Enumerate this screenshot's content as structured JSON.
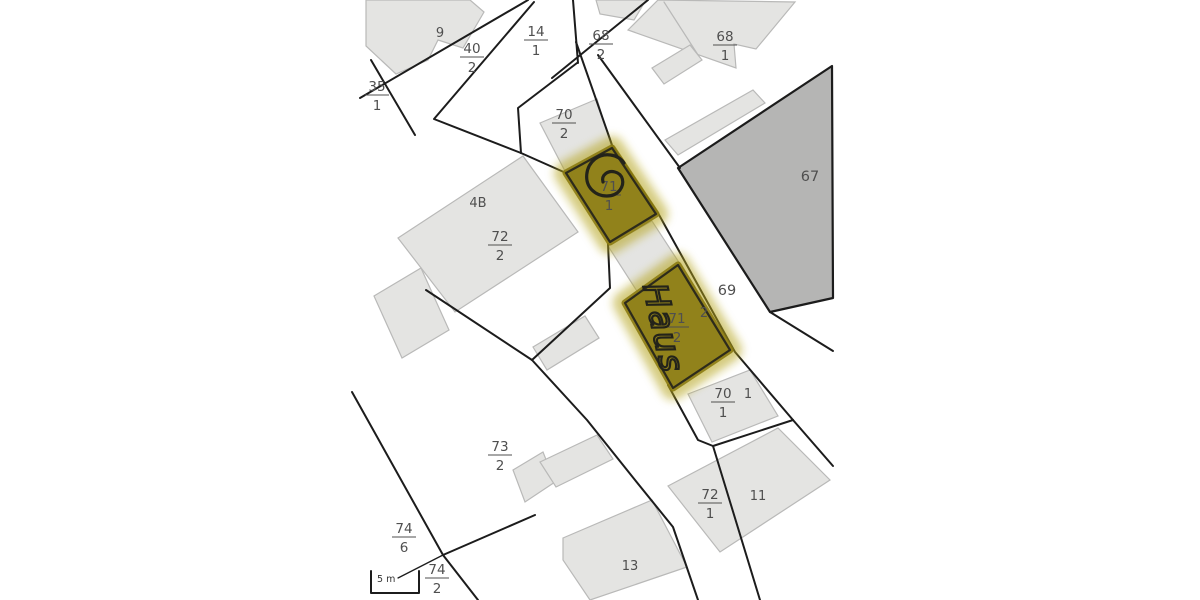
{
  "map": {
    "type": "cadastral-parcel-map",
    "scale_bar": {
      "label": "5 m"
    },
    "annotations": {
      "handwritten_text": "Haus"
    },
    "colors": {
      "background": "#ffffff",
      "line": "#1c1c1c",
      "building-fill": "#e4e4e2",
      "building-stroke": "#b9b9b8",
      "dark-parcel-fill": "#b5b5b4",
      "label": "#4f4f4f",
      "highlight-fill": "#8a7a10",
      "highlight-halo": "#b3a214",
      "ink": "#23231a"
    },
    "parcel_labels": {
      "f14_1": {
        "num": "14",
        "den": "1"
      },
      "f40_2": {
        "num": "40",
        "den": "2"
      },
      "f35_1": {
        "num": "35",
        "den": "1"
      },
      "f68_2": {
        "num": "68",
        "den": "2"
      },
      "f68_1": {
        "num": "68",
        "den": "1"
      },
      "f70_2": {
        "num": "70",
        "den": "2"
      },
      "f71_1": {
        "num": "71",
        "den": "1"
      },
      "f72_2": {
        "num": "72",
        "den": "2"
      },
      "f71_2": {
        "num": "71",
        "den": "2"
      },
      "f70_1": {
        "num": "70",
        "den": "1"
      },
      "f73_2": {
        "num": "73",
        "den": "2"
      },
      "f72_1": {
        "num": "72",
        "den": "1"
      },
      "f74_6": {
        "num": "74",
        "den": "6"
      },
      "f74_2": {
        "num": "74",
        "den": "2"
      }
    },
    "point_labels": {
      "building_9": "9",
      "building_4b": "4B",
      "parcel_67": "67",
      "parcel_69": "69",
      "house_2": "2",
      "house_1": "1",
      "house_11": "11",
      "house_13": "13"
    }
  }
}
